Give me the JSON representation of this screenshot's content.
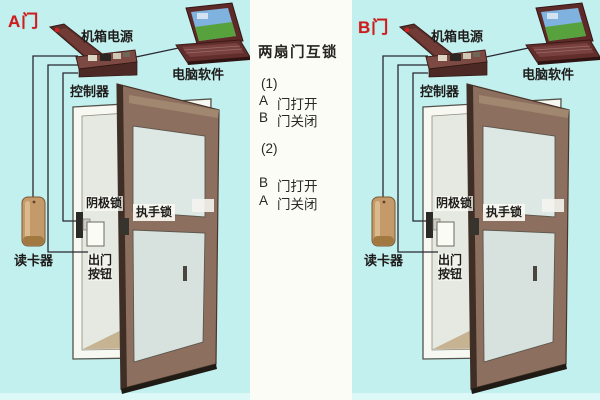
{
  "colors": {
    "background": "#c2f0ef",
    "divider": "#fcfcf6",
    "title_red": "#ce1c1c",
    "text": "#1e1c1a"
  },
  "panels": [
    {
      "title": "A门",
      "labels": {
        "power_box": "机箱电源",
        "software": "电脑软件",
        "controller": "控制器",
        "cathode_lock": "阴极锁",
        "handle_lock": "执手锁",
        "card_reader": "读卡器",
        "exit_button_l1": "出门",
        "exit_button_l2": "按钮"
      }
    },
    {
      "title": "B门",
      "labels": {
        "power_box": "机箱电源",
        "software": "电脑软件",
        "controller": "控制器",
        "cathode_lock": "阴极锁",
        "handle_lock": "执手锁",
        "card_reader": "读卡器",
        "exit_button_l1": "出门",
        "exit_button_l2": "按钮"
      }
    }
  ],
  "center": {
    "title": "两扇门互锁",
    "cases": [
      {
        "num": "(1)",
        "lines": [
          {
            "door": "A",
            "state": "门打开"
          },
          {
            "door": "B",
            "state": "门关闭"
          }
        ]
      },
      {
        "num": "(2)",
        "lines": [
          {
            "door": "B",
            "state": "门打开"
          },
          {
            "door": "A",
            "state": "门关闭"
          }
        ]
      }
    ]
  }
}
